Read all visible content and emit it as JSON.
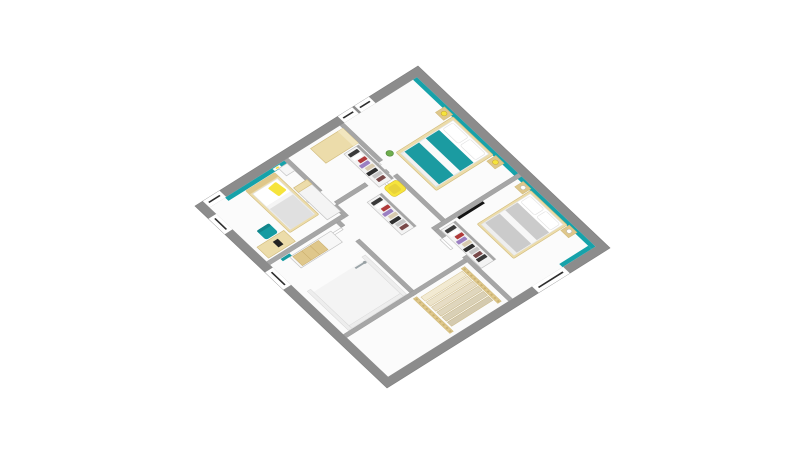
{
  "meta": {
    "type": "3d-floor-plan-render",
    "view": "axonometric-top-down",
    "floor": "upper-floor",
    "background": "#ffffff",
    "visible_text": ""
  },
  "colors": {
    "background": "#ffffff",
    "floor_white": "#fbfbfb",
    "wall_gray": "#8c8c8c",
    "interior_wall_gray": "#a6a6a6",
    "teal_wall": "#16a2aa",
    "teal_duvet": "#1b9ba1",
    "teal_accent": "#169ba1",
    "teal_accent_dark": "#12858b",
    "wood_light": "#ecdcaa",
    "wood_mid": "#dfc78b",
    "stair_tread": "#f2ead2",
    "yellow": "#f6e43c",
    "duvet_gray": "#cbcbcb",
    "pillow_white": "#ffffff",
    "lamp_white": "#ffffff",
    "tv_black": "#141414",
    "plant_green": "#6fae4e",
    "door_white": "#fefefe",
    "window_white": "#ffffff",
    "window_glazing": "#2e2e2e",
    "shower_chrome": "#9aa4a8",
    "closet_white": "#f3f3f3"
  },
  "floor_plan": {
    "exterior": {
      "shape": "square-rotated-diamond",
      "wall": "thick-gray-band",
      "windows": [
        {
          "wall": "west",
          "room": "dressing",
          "lights": 2
        },
        {
          "wall": "west",
          "room": "bedroom-2",
          "lights": 1
        },
        {
          "wall": "south",
          "room": "bedroom-2",
          "lights": 1
        },
        {
          "wall": "south",
          "room": "bathroom",
          "lights": 1
        },
        {
          "wall": "east",
          "room": "bedroom-3",
          "lights": 1
        }
      ]
    },
    "rooms": [
      {
        "id": "master-bedroom",
        "position": "top",
        "accent_wall": "teal",
        "furniture": [
          "double-bed-teal-duvet",
          "two-wood-nightstands",
          "two-yellow-lamps",
          "white-pillows",
          "green-plant"
        ]
      },
      {
        "id": "dressing",
        "position": "center-left",
        "furniture": [
          "beige-cabinet",
          "open-closet-row-1",
          "open-closet-row-2",
          "yellow-armchair"
        ]
      },
      {
        "id": "bedroom-3",
        "position": "right",
        "accent_wall": "teal",
        "furniture": [
          "double-bed-gray-duvet",
          "two-wood-nightstands",
          "two-white-lamps",
          "wall-tv",
          "open-closet-row"
        ]
      },
      {
        "id": "bedroom-2",
        "position": "left",
        "accent_wall": "teal",
        "furniture": [
          "single-bed-yellow-pillow",
          "white-nightstand",
          "white-armoire",
          "desk",
          "teal-desk-chair",
          "wall-picture"
        ]
      },
      {
        "id": "hallway-landing",
        "position": "center",
        "furniture": [
          "interior-doors"
        ]
      },
      {
        "id": "bathroom",
        "position": "bottom",
        "furniture": [
          "vanity-wood-drawers",
          "walk-in-shower",
          "chrome-shower-column",
          "teal-towel"
        ]
      },
      {
        "id": "staircase",
        "position": "bottom-right",
        "furniture": [
          "wood-railings",
          "balusters",
          "stair-treads"
        ]
      }
    ],
    "clothes_palette": [
      "#3a3a3a",
      "#ffffff",
      "#b03a3a",
      "#9b7fc2",
      "#d8cbb0",
      "#2f2f2f",
      "#c6c6c6",
      "#7a4a4a"
    ],
    "stairs": {
      "treads": 6,
      "railings": 2
    },
    "projection_matrix": [
      0.48,
      0.455,
      -0.5575,
      0.35,
      418,
      66
    ]
  }
}
